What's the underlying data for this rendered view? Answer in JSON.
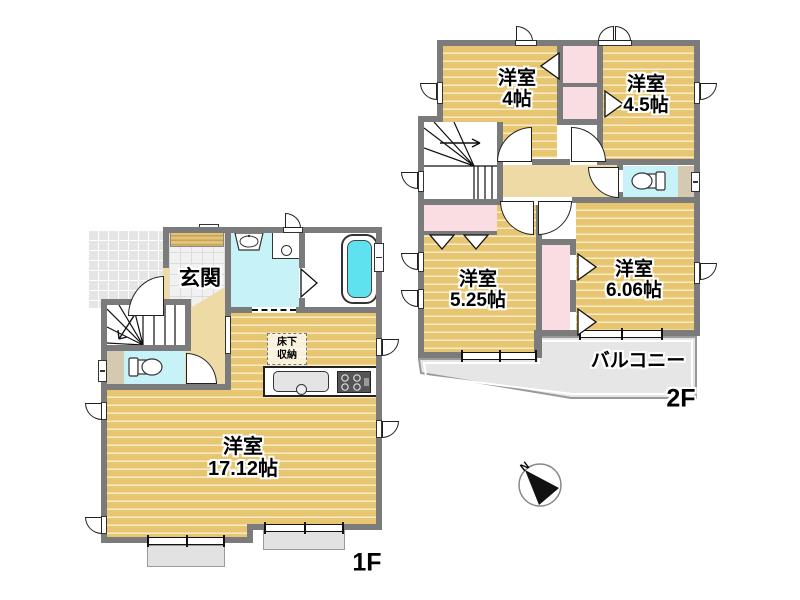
{
  "floor1": {
    "label": "1F",
    "genkan": "玄関",
    "living": {
      "name": "洋室",
      "size": "17.12帖"
    },
    "floor_storage": {
      "line1": "床下",
      "line2": "収納"
    }
  },
  "floor2": {
    "label": "2F",
    "room4": {
      "name": "洋室",
      "size": "4帖"
    },
    "room45": {
      "name": "洋室",
      "size": "4.5帖"
    },
    "room525": {
      "name": "洋室",
      "size": "5.25帖"
    },
    "room606": {
      "name": "洋室",
      "size": "6.06帖"
    },
    "balcony": "バルコニー"
  },
  "compass": {
    "north": "N"
  },
  "colors": {
    "wall": "#7b7b7b",
    "wood_floor": "#e8c671",
    "wood_stripe": "#f6ecc8",
    "hallway": "#eedaa4",
    "wet_room": "#c7f2f8",
    "bathtub": "#5fe2ef",
    "closet": "#fadde2",
    "balcony": "#e6e6e6",
    "outdoor_tile": "#e5e5e5"
  }
}
